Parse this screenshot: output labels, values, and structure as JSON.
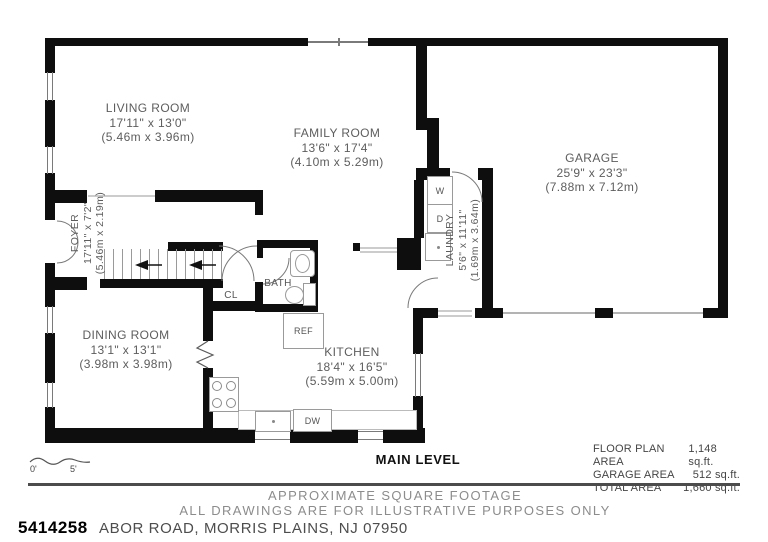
{
  "rooms": {
    "living": {
      "name": "LIVING ROOM",
      "imperial": "17'11\" x 13'0\"",
      "metric": "(5.46m x 3.96m)"
    },
    "family": {
      "name": "FAMILY ROOM",
      "imperial": "13'6\" x 17'4\"",
      "metric": "(4.10m x 5.29m)"
    },
    "garage": {
      "name": "GARAGE",
      "imperial": "25'9\" x 23'3\"",
      "metric": "(7.88m x 7.12m)"
    },
    "foyer": {
      "name": "FOYER",
      "imperial": "17'11\" x 7'2\"",
      "metric": "(5.46m x 2.19m)"
    },
    "laundry": {
      "name": "LAUNDRY",
      "imperial": "5'6\" x 11'11\"",
      "metric": "(1.69m x 3.64m)"
    },
    "dining": {
      "name": "DINING ROOM",
      "imperial": "13'1\" x 13'1\"",
      "metric": "(3.98m x 3.98m)"
    },
    "kitchen": {
      "name": "KITCHEN",
      "imperial": "18'4\" x 16'5\"",
      "metric": "(5.59m x 5.00m)"
    }
  },
  "fixtures": {
    "washer": "W",
    "dryer": "D",
    "closet": "CL",
    "bath": "BATH",
    "fridge": "REF",
    "dishwasher": "DW"
  },
  "scale": {
    "start": "0'",
    "end": "5'"
  },
  "level_label": "MAIN LEVEL",
  "areas": [
    {
      "label": "FLOOR PLAN AREA",
      "value": "1,148 sq.ft."
    },
    {
      "label": "GARAGE AREA",
      "value": "512 sq.ft."
    },
    {
      "label": "TOTAL AREA",
      "value": "1,660 sq.ft."
    }
  ],
  "disclaimer": {
    "line1": "APPROXIMATE SQUARE FOOTAGE",
    "line2": "ALL DRAWINGS ARE FOR ILLUSTRATIVE PURPOSES ONLY"
  },
  "footer": {
    "listing_number": "5414258",
    "address_visible": "ABOR ROAD, MORRIS PLAINS, NJ 07950"
  },
  "colors": {
    "wall": "#0e0e0e",
    "label_gray": "#5d5d5d",
    "muted_gray": "#8c8c8c"
  }
}
